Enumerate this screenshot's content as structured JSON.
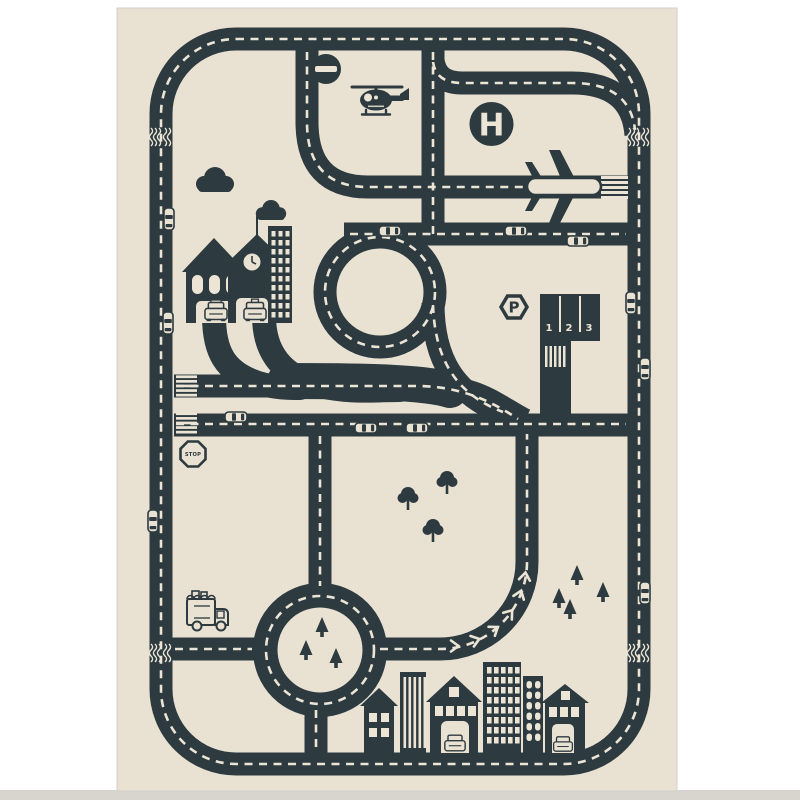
{
  "colors": {
    "road": "#2d3a3f",
    "mat": "#e9e2d3",
    "marking": "#ece5d6",
    "margin": "#ffffff",
    "photo_edge": "#d8d5cf"
  },
  "signs": {
    "helipad_label": "H",
    "parking_label": "P",
    "stop_label": "STOP",
    "no_entry": "no-entry-bar"
  },
  "parking": {
    "stalls": [
      "1",
      "2",
      "3"
    ]
  },
  "cars": [
    {
      "x": 169,
      "y": 219,
      "dir": "v"
    },
    {
      "x": 168,
      "y": 323,
      "dir": "v"
    },
    {
      "x": 153,
      "y": 521,
      "dir": "v"
    },
    {
      "x": 390,
      "y": 231,
      "dir": "h"
    },
    {
      "x": 516,
      "y": 231,
      "dir": "h"
    },
    {
      "x": 578,
      "y": 241,
      "dir": "h"
    },
    {
      "x": 236,
      "y": 417,
      "dir": "h"
    },
    {
      "x": 366,
      "y": 428,
      "dir": "h"
    },
    {
      "x": 417,
      "y": 428,
      "dir": "h"
    },
    {
      "x": 631,
      "y": 303,
      "dir": "v"
    },
    {
      "x": 645,
      "y": 369,
      "dir": "v"
    },
    {
      "x": 645,
      "y": 593,
      "dir": "v"
    }
  ],
  "pine_trees": [
    {
      "x": 322,
      "y": 630
    },
    {
      "x": 306,
      "y": 653
    },
    {
      "x": 336,
      "y": 661
    },
    {
      "x": 577,
      "y": 578
    },
    {
      "x": 603,
      "y": 595
    },
    {
      "x": 570,
      "y": 612
    },
    {
      "x": 559,
      "y": 601
    }
  ],
  "round_trees": [
    {
      "x": 408,
      "y": 505
    },
    {
      "x": 447,
      "y": 489
    },
    {
      "x": 433,
      "y": 537
    }
  ],
  "chevrons": [
    {
      "x": 455,
      "y": 646,
      "r": 90
    },
    {
      "x": 476,
      "y": 640,
      "r": 72
    },
    {
      "x": 495,
      "y": 629,
      "r": 55
    },
    {
      "x": 510,
      "y": 613,
      "r": 38
    },
    {
      "x": 520,
      "y": 594,
      "r": 20
    },
    {
      "x": 525,
      "y": 576,
      "r": 8
    }
  ],
  "rumbles": [
    {
      "x": 161,
      "y": 128
    },
    {
      "x": 639,
      "y": 128
    },
    {
      "x": 161,
      "y": 644
    },
    {
      "x": 639,
      "y": 644
    }
  ]
}
